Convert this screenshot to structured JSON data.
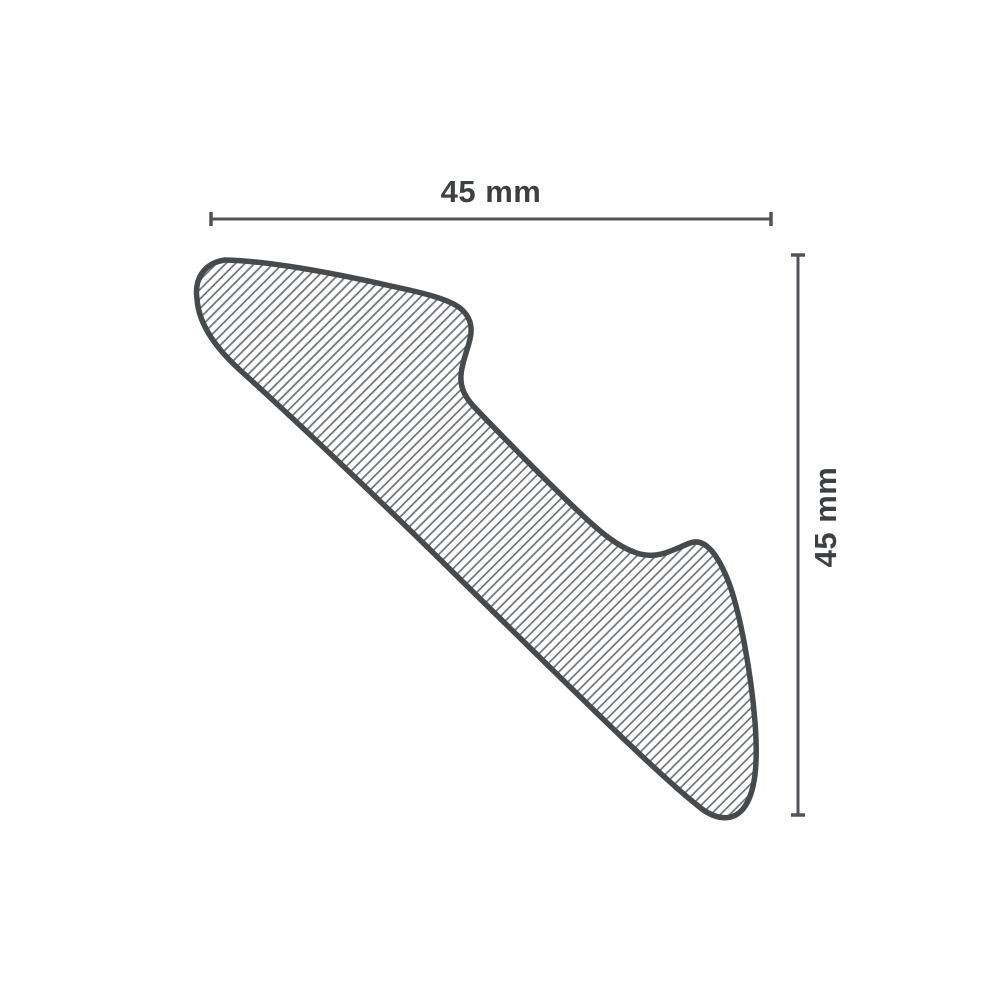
{
  "diagram": {
    "dimensions": {
      "width": {
        "label": "45 mm",
        "value": 45,
        "unit": "mm",
        "orientation": "horizontal"
      },
      "height": {
        "label": "45 mm",
        "value": 45,
        "unit": "mm",
        "orientation": "vertical"
      }
    },
    "colors": {
      "outline": "#474a4c",
      "hatch": "#6e7174",
      "dimension": "#515457",
      "text": "#3e4143",
      "background": "#ffffff"
    }
  }
}
